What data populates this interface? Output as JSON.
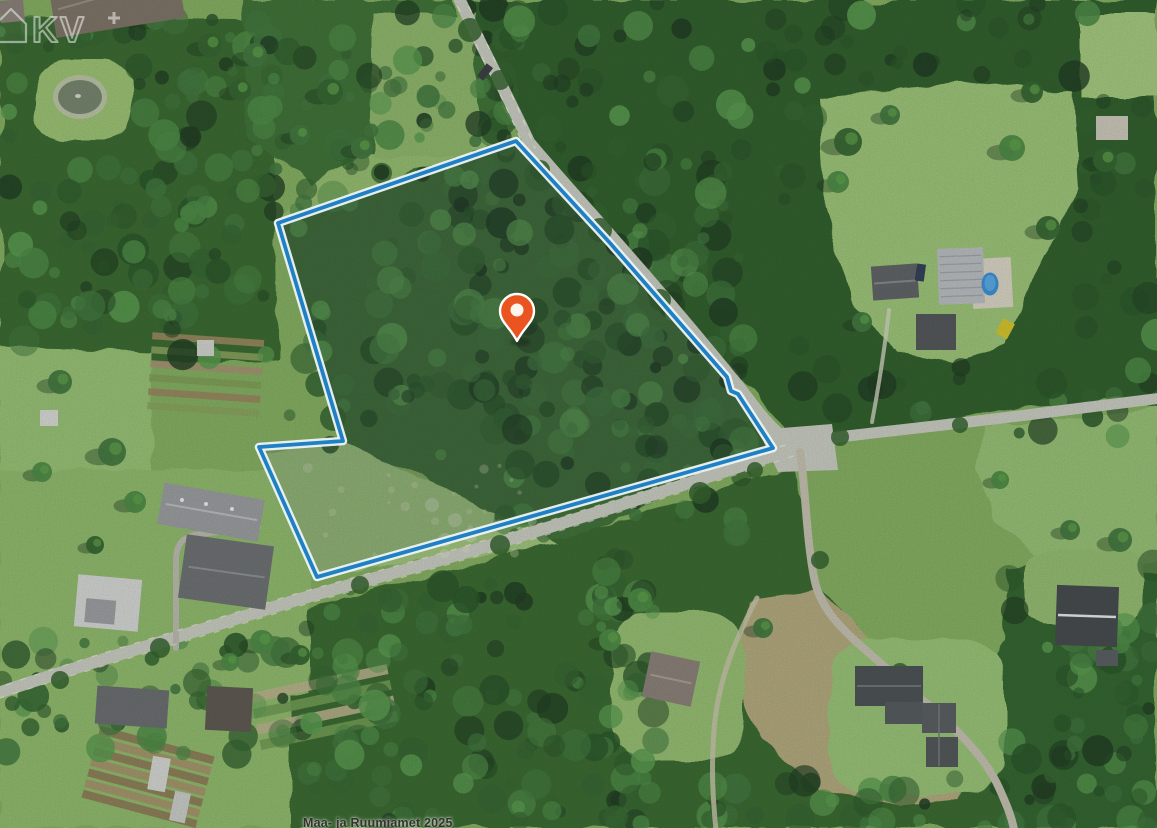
{
  "map": {
    "description": "Aerial satellite view of rural plot with highlighted cadastral boundary",
    "attribution": "Maa- ja Ruumiamet 2025",
    "watermark": {
      "text": "KV",
      "symbol": "house-icon"
    },
    "boundary": {
      "stroke_color": "#1f80c6",
      "casing_color": "#edf4f6",
      "fill_tint": "#233040",
      "points": "516,141 610,243 727,377 731,391 738,394 773,448 317,577 259,447 343,441 278,223"
    },
    "pin": {
      "x": 517,
      "y": 341,
      "color": "#e95420",
      "hole_color": "#fdf4ec"
    }
  }
}
